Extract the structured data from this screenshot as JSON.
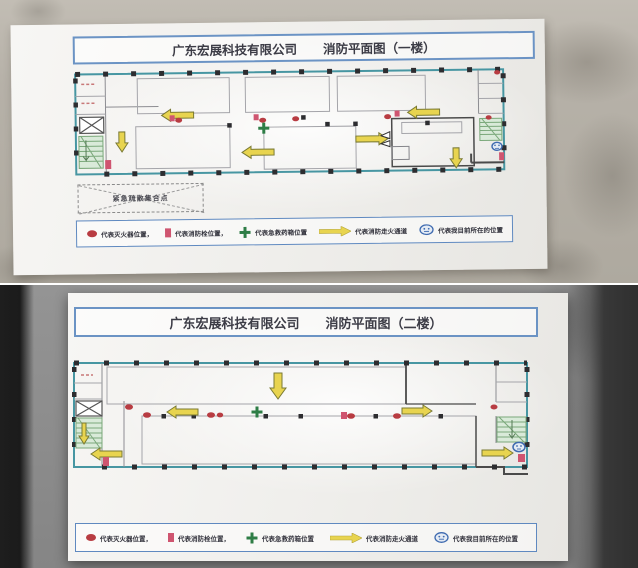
{
  "photos": [
    {
      "id": "floor-1",
      "title": {
        "company": "广东宏展科技有限公司",
        "plan": "消防平面图（一楼）"
      },
      "assembly_label": "紧急疏散集合点",
      "legend": {
        "items": [
          {
            "symbol": "fire-extinguisher",
            "label": "代表灭火器位置，"
          },
          {
            "symbol": "fire-hydrant",
            "label": "代表消防栓位置，"
          },
          {
            "symbol": "first-aid-kit",
            "label": "代表急救药箱位置"
          },
          {
            "symbol": "escape-route",
            "label": "代表消防走火通道"
          },
          {
            "symbol": "current-location",
            "label": "代表我目前所在的位置"
          }
        ]
      }
    },
    {
      "id": "floor-2",
      "title": {
        "company": "广东宏展科技有限公司",
        "plan": "消防平面图（二楼）"
      },
      "legend": {
        "items": [
          {
            "symbol": "fire-extinguisher",
            "label": "代表灭火器位置，"
          },
          {
            "symbol": "fire-hydrant",
            "label": "代表消防栓位置，"
          },
          {
            "symbol": "first-aid-kit",
            "label": "代表急救药箱位置"
          },
          {
            "symbol": "escape-route",
            "label": "代表消防走火通道"
          },
          {
            "symbol": "current-location",
            "label": "代表我目前所在的位置"
          }
        ]
      }
    }
  ],
  "colors": {
    "wall_teal": "#4796a2",
    "arrow_yellow": "#e8d44f",
    "extinguisher_red": "#b83c42",
    "hydrant_red": "#cf5570",
    "first_aid_green": "#2e7d46",
    "location_blue": "#3f6bb0",
    "stairs_green": "#7aa87a",
    "title_border_blue": "#6b93c4"
  }
}
